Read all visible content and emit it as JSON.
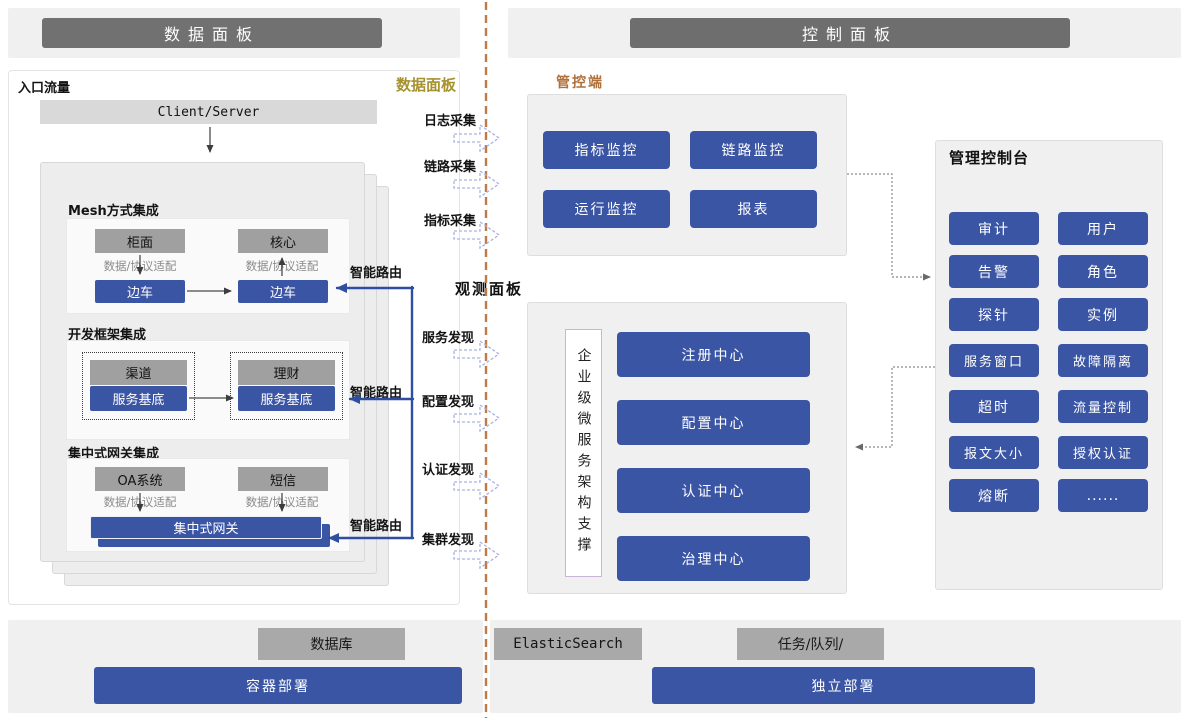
{
  "headers": {
    "left": "数据面板",
    "right": "控制面板"
  },
  "colors": {
    "accent_blue": "#3b55a5",
    "header_gray": "#717171",
    "gold_label": "#a6922e",
    "orange_label": "#b0703a",
    "divider_dash": "#c07a45"
  },
  "data_panel": {
    "corner_label": "数据面板",
    "entry_label": "入口流量",
    "client_server": "Client/Server",
    "adapter_label": "数据/协议适配",
    "smart_route_label": "智能路由",
    "sections": [
      {
        "title": "Mesh方式集成",
        "top_left": "柜面",
        "top_right": "核心",
        "bottom_left": "边车",
        "bottom_right": "边车"
      },
      {
        "title": "开发框架集成",
        "top_left": "渠道",
        "top_right": "理财",
        "bottom_left": "服务基底",
        "bottom_right": "服务基底"
      },
      {
        "title": "集中式网关集成",
        "top_left": "OA系统",
        "top_right": "短信",
        "gateway": "集中式网关"
      }
    ]
  },
  "flow": {
    "collect": [
      "日志采集",
      "链路采集",
      "指标采集"
    ],
    "observe_label": "观测面板",
    "discover": [
      "服务发现",
      "配置发现",
      "认证发现",
      "集群发现"
    ]
  },
  "control_plane": {
    "label": "管控端",
    "buttons": [
      "指标监控",
      "链路监控",
      "运行监控",
      "报表"
    ]
  },
  "observe": {
    "vertical_label": "企业级微服务架构支撑",
    "buttons": [
      "注册中心",
      "配置中心",
      "认证中心",
      "治理中心"
    ]
  },
  "admin_console": {
    "title": "管理控制台",
    "buttons": [
      "审计",
      "用户",
      "告警",
      "角色",
      "探针",
      "实例",
      "服务窗口",
      "故障隔离",
      "超时",
      "流量控制",
      "报文大小",
      "授权认证",
      "熔断",
      "......"
    ]
  },
  "infra": {
    "db": "数据库",
    "es": "ElasticSearch",
    "queue": "任务/队列/",
    "container_deploy": "容器部署",
    "standalone_deploy": "独立部署"
  }
}
